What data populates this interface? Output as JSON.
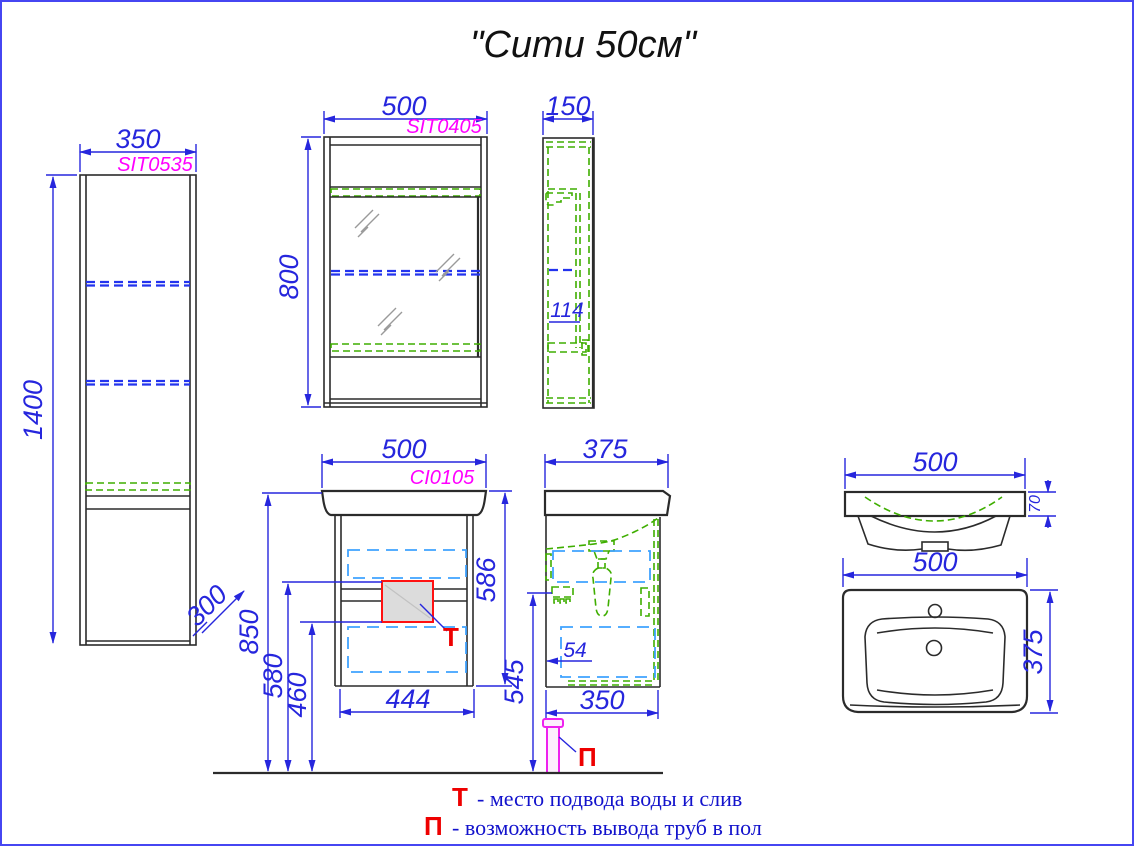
{
  "title": "\"Сити 50см\"",
  "tall_cabinet": {
    "width": "350",
    "code": "SIT0535",
    "height": "1400",
    "depth": "300"
  },
  "mirror_front": {
    "width": "500",
    "code": "SIT0405",
    "height": "800"
  },
  "mirror_side": {
    "width": "150",
    "shelf_depth": "114"
  },
  "vanity_front": {
    "width": "500",
    "code": "CI0105",
    "body_height": "586",
    "total_height": "850",
    "supply_height": "580",
    "supply_low_height": "460",
    "inner_width": "444",
    "supply_marker": "Т"
  },
  "vanity_side": {
    "depth": "375",
    "drain_height": "545",
    "back_gap": "54",
    "body_depth": "350",
    "floor_marker": "П"
  },
  "sink_front": {
    "width": "500",
    "rim_height": "70"
  },
  "sink_top": {
    "width": "500",
    "depth": "375"
  },
  "legend": {
    "supply_symbol": "Т",
    "supply_text": "- место подвода воды и слив",
    "floor_symbol": "П",
    "floor_text": "- возможность вывода труб в пол"
  },
  "colors": {
    "dimension_blue": "#2626dd",
    "code_magenta": "#ff00ff",
    "hidden_green": "#3fae00",
    "drawer_cyan": "#3fa2ff",
    "marker_red": "#ee0000",
    "pipe_magenta": "#ee22ee"
  }
}
